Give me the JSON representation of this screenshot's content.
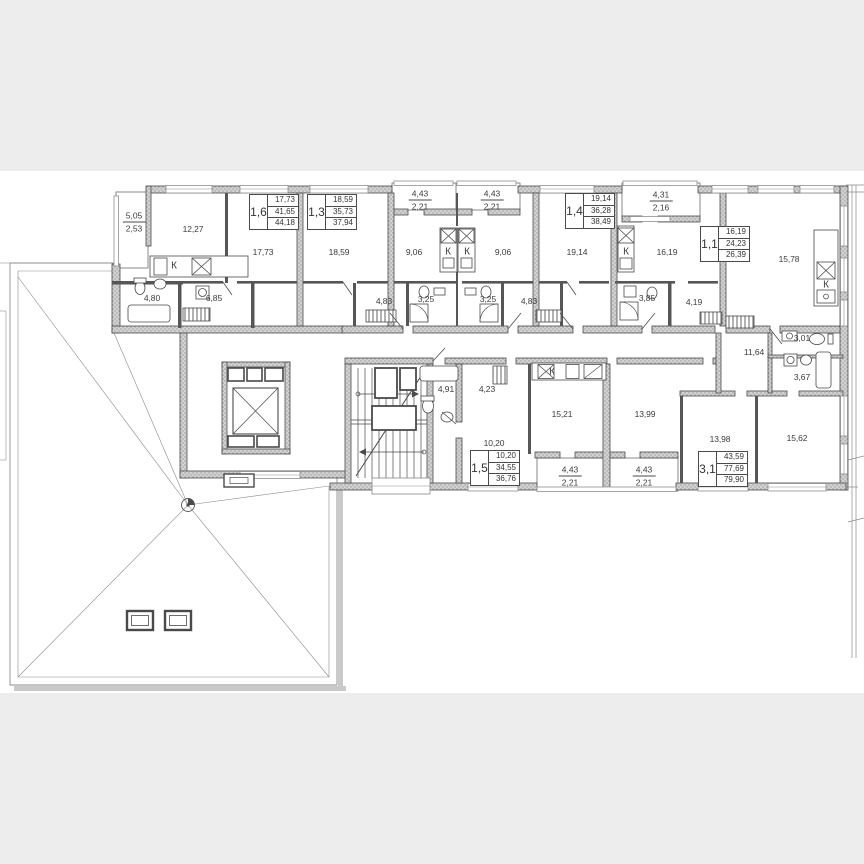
{
  "plan": {
    "kitchen_label": "К",
    "units": [
      {
        "number": "1,6",
        "living": "17,73",
        "area": "41,65",
        "total": "44,18"
      },
      {
        "number": "1,3",
        "living": "18,59",
        "area": "35,73",
        "total": "37,94"
      },
      {
        "number": "1,4",
        "living": "19,14",
        "area": "36,28",
        "total": "38,49"
      },
      {
        "number": "1,1",
        "living": "16,19",
        "area": "24,23",
        "total": "26,39"
      },
      {
        "number": "1,5",
        "living": "10,20",
        "area": "34,55",
        "total": "36,76"
      },
      {
        "number": "3,1",
        "living": "43,59",
        "area": "77,69",
        "total": "79,90"
      }
    ],
    "rooms": [
      {
        "area": "12,27"
      },
      {
        "area": "17,73"
      },
      {
        "area": "18,59"
      },
      {
        "area": "9,06"
      },
      {
        "area": "9,06"
      },
      {
        "area": "19,14"
      },
      {
        "area": "16,19"
      },
      {
        "area": "15,78"
      },
      {
        "area": "4,80"
      },
      {
        "area": "6,85"
      },
      {
        "area": "4,83"
      },
      {
        "area": "3,25"
      },
      {
        "area": "3,25"
      },
      {
        "area": "4,83"
      },
      {
        "area": "3,85"
      },
      {
        "area": "4,19"
      },
      {
        "area": "3,01"
      },
      {
        "area": "11,64"
      },
      {
        "area": "3,67"
      },
      {
        "area": "4,91"
      },
      {
        "area": "4,23"
      },
      {
        "area": "15,21"
      },
      {
        "area": "10,20"
      },
      {
        "area": "13,99"
      },
      {
        "area": "13,98"
      },
      {
        "area": "15,62"
      }
    ],
    "balconies": [
      {
        "area": "5,05",
        "reduced": "2,53"
      },
      {
        "area": "4,43",
        "reduced": "2,21"
      },
      {
        "area": "4,43",
        "reduced": "2,21"
      },
      {
        "area": "4,31",
        "reduced": "2,16"
      },
      {
        "area": "4,43",
        "reduced": "2,21"
      },
      {
        "area": "4,43",
        "reduced": "2,21"
      }
    ],
    "colors": {
      "page_bg": "#ededed",
      "sheet_bg": "#ffffff",
      "line": "#4a4a4a",
      "wall_fill": "#cdcdcd"
    }
  }
}
